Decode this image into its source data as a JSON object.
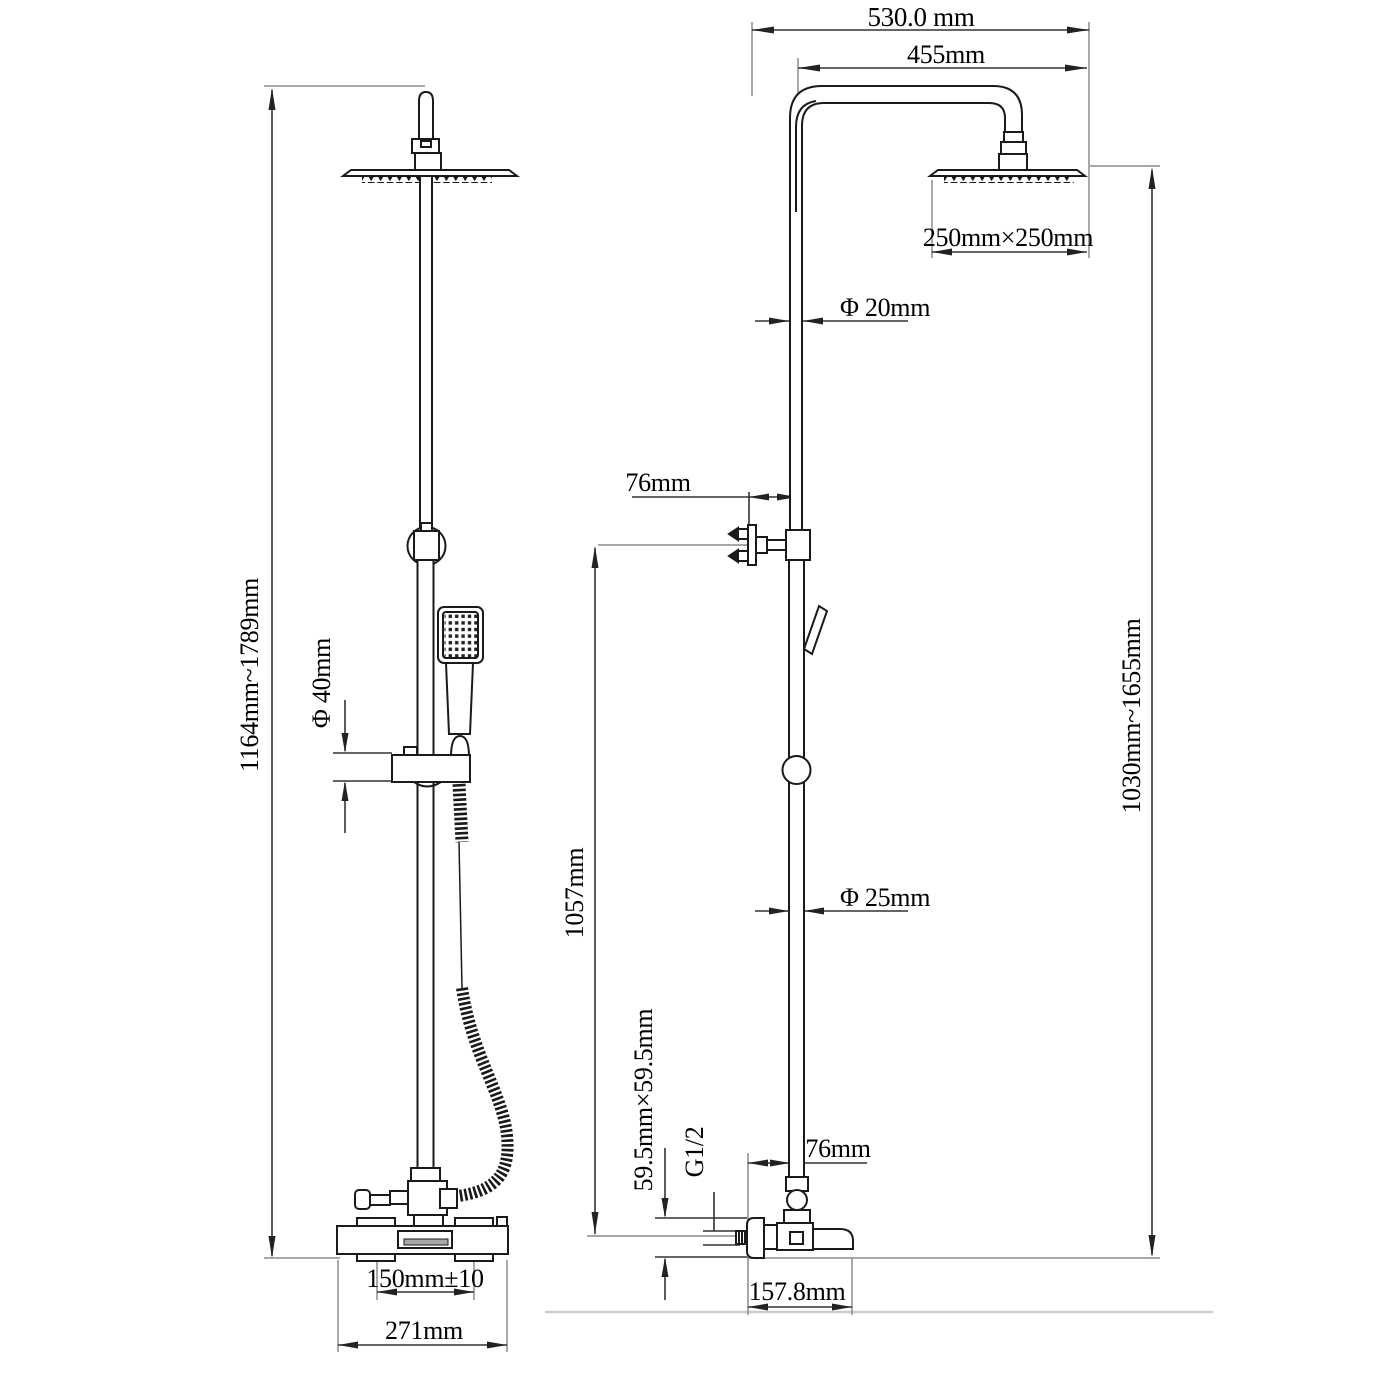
{
  "drawing_type": "shower-system-dimension-drawing",
  "colors": {
    "background": "#ffffff",
    "object_line": "#1a1a1a",
    "dimension_line": "#333333",
    "extension_line": "#8c8c8c",
    "floor_line": "#cccccc",
    "text": "#000000"
  },
  "labels": {
    "front": {
      "height_range": "1164mm~1789mm",
      "slider_diameter": "Φ 40mm",
      "inlet_centers": "150mm±10",
      "base_width": "271mm"
    },
    "side": {
      "top_width": "530.0 mm",
      "arm_reach": "455mm",
      "head_size": "250mm×250mm",
      "upper_pipe_diameter": "Φ 20mm",
      "upper_wall_offset": "76mm",
      "lower_pipe_diameter": "Φ 25mm",
      "slide_bar_height": "1057mm",
      "riser_height_range": "1030mm~1655mm",
      "escutcheon_size": "59.5mm×59.5mm",
      "thread_spec": "G1/2",
      "lower_wall_offset": "76mm",
      "spout_reach": "157.8mm"
    }
  }
}
